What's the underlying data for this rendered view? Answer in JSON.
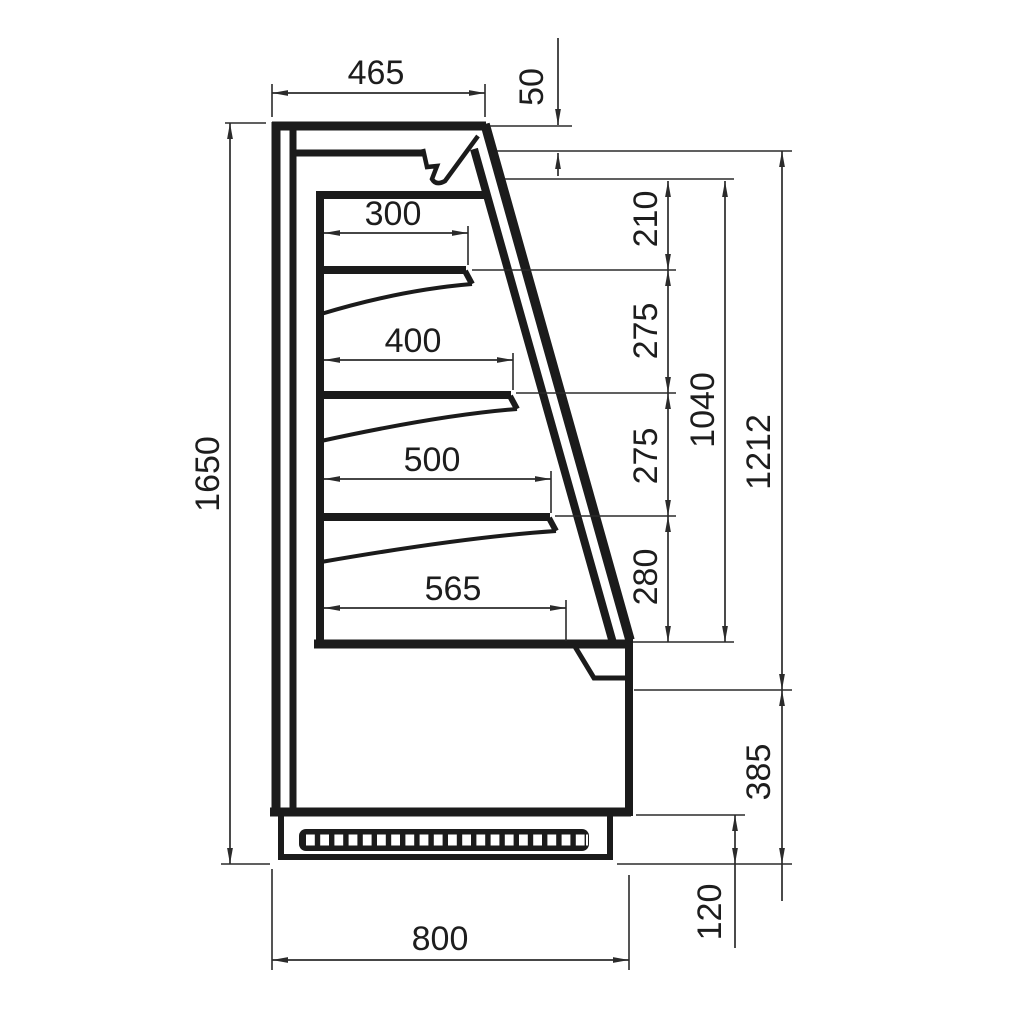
{
  "drawing": {
    "subject": "Refrigerated wall display case — side section drawing with dimensions",
    "units": "mm",
    "colors": {
      "line": "#1b1b1b",
      "dimension_line": "#2b2b2b",
      "background": "#ffffff"
    },
    "labels": {
      "top_depth": "465",
      "canopy_height": "50",
      "shelf1_depth": "300",
      "shelf2_depth": "400",
      "shelf3_depth": "500",
      "bottom_shelf_depth": "565",
      "top_gap": "210",
      "gap_upper": "275",
      "gap_lower": "275",
      "bottom_gap": "280",
      "opening_height": "1040",
      "front_height": "1212",
      "overall_height": "1650",
      "front_panel_height": "385",
      "plinth_height": "120",
      "overall_depth": "800"
    }
  }
}
